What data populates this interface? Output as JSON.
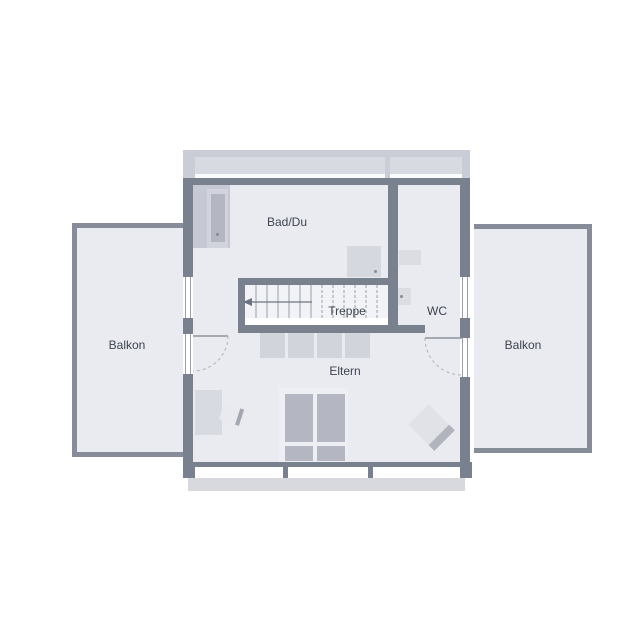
{
  "plan": {
    "type": "floor-plan-upper-storey",
    "rooms": {
      "bad_du": {
        "label": "Bad/Du"
      },
      "treppe": {
        "label": "Treppe"
      },
      "wc": {
        "label": "WC"
      },
      "eltern": {
        "label": "Eltern"
      },
      "balkon_left": {
        "label": "Balkon"
      },
      "balkon_right": {
        "label": "Balkon"
      }
    },
    "colors": {
      "wall": "#79808e",
      "floor": "#e9ebf1",
      "background": "#ffffff",
      "roof_band": "#cbcdd6",
      "roof_window": "#d8dae2",
      "railing": "#868d99",
      "furniture_light": "#d8dae1",
      "furniture_mid": "#c6c9d3",
      "furniture_dark": "#b4b7c1",
      "bottom_band": "#d7d9df",
      "text": "#3e4450",
      "line": "#9aa0ab"
    }
  }
}
